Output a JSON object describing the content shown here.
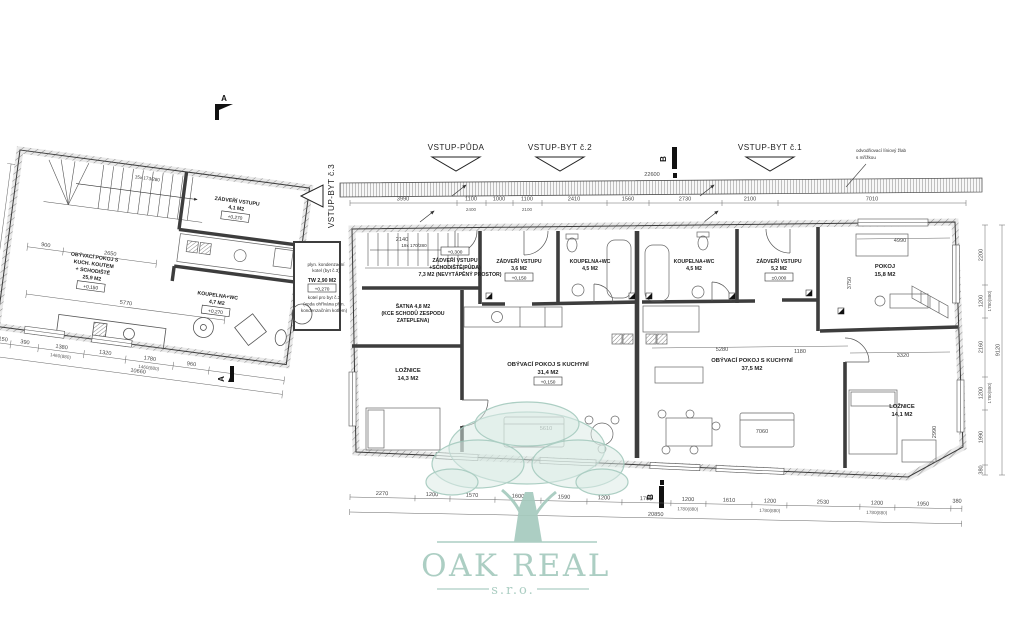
{
  "watermark": {
    "name": "OAK REAL",
    "suffix": "s.r.o.",
    "color": "#a5cabe"
  },
  "entries": {
    "puda": "VSTUP-PŮDA",
    "byt2": "VSTUP-BYT č.2",
    "byt1": "VSTUP-BYT č.1",
    "byt3": "VSTUP-BYT č.3"
  },
  "sections": {
    "a": "A",
    "b": "B"
  },
  "notes": {
    "drain_l1": "odvodňovací líniový žlab",
    "drain_l2": "s mřížkou",
    "boiler_l1": "plyn. kondenzační",
    "boiler_l2": "kotel (byt č.3)",
    "tw": "TW 2,90 M2",
    "boiler_l3": "kotel pro byt č.3",
    "boiler_l4": "(voda ohřívána plyn.",
    "boiler_l5": "kondenzačním kotlem)",
    "stair_left": "15x 173/280",
    "stair_main": "19x 170/280"
  },
  "rooms": {
    "obyv3": {
      "l1": "OBÝVACÍ POKOJ S",
      "l2": "KUCH. KOUTEM",
      "l3": "+ SCHODIŠTĚ",
      "area": "25,9 M2",
      "elev": "+0,150"
    },
    "zadveri3": {
      "l1": "ZÁDVEŘÍ VSTUPU",
      "area": "4,1 M2",
      "elev": "+0,270"
    },
    "koupelna3": {
      "l1": "KOUPELNA+WC",
      "area": "4,7 M2",
      "elev": "+0,270"
    },
    "zadveri_puda": {
      "l1": "ZÁDVEŘÍ VSTUPU",
      "l2": "+SCHODIŠTĚ(PŮDA)",
      "l3": "7,3 M2 (NEVYTÁPĚNÝ PROSTOR)",
      "elev": "+0,300"
    },
    "satna": {
      "l1": "ŠATNA 4,8 M2",
      "l2": "(KCE SCHODŮ ZESPODU",
      "l3": "ZATEPLENA)"
    },
    "zadveri2": {
      "l1": "ZÁDVEŘÍ VSTUPU",
      "area": "3,6 M2",
      "elev": "+0,150"
    },
    "koupelna2": {
      "l1": "KOUPELNA+WC",
      "area": "4,5 M2"
    },
    "koupelna1": {
      "l1": "KOUPELNA+WC",
      "area": "4,5 M2"
    },
    "zadveri1": {
      "l1": "ZÁDVEŘÍ VSTUPU",
      "area": "5,2 M2",
      "elev": "±0,000"
    },
    "pokoj": {
      "l1": "POKOJ",
      "area": "15,8 M2"
    },
    "loznice2": {
      "l1": "LOŽNICE",
      "area": "14,3 M2"
    },
    "obyv2": {
      "l1": "OBÝVACÍ POKOJ S KUCHYNÍ",
      "area": "31,4 M2",
      "elev": "+0,150"
    },
    "obyv1": {
      "l1": "OBÝVACÍ POKOJ S KUCHYNÍ",
      "area": "37,5 M2"
    },
    "loznice1": {
      "l1": "LOŽNICE",
      "area": "14,1 M2"
    }
  },
  "elevations": {
    "minus300": "-0,300"
  },
  "dims": {
    "top": [
      "3990",
      "1100",
      "1000",
      "1100",
      "2410",
      "1560",
      "2730",
      "2100",
      "7010"
    ],
    "top_total": "22600",
    "top_sub1": "2400",
    "top_sub2": "2100",
    "bottom": [
      "2270",
      "1200",
      "1570",
      "1600",
      "1590",
      "1200",
      "1700",
      "1200",
      "1610",
      "1200",
      "2530",
      "1200",
      "1950",
      "380"
    ],
    "bottom_total": "20850",
    "bottom_sub": "1780(880)",
    "right": [
      "2200",
      "1200",
      "2160",
      "1200",
      "1990",
      "380"
    ],
    "right_total": "9120",
    "right_sub": "1780(880)",
    "left": [
      "150",
      "390",
      "1380",
      "1320",
      "1780",
      "960"
    ],
    "left_total": "10660",
    "left_sub": "1460(880)",
    "left_top1": "900",
    "left_top2": "2650",
    "left_mid": "5770",
    "left_v": "4480",
    "inner": {
      "a": "5280",
      "b": "1180",
      "c": "5610",
      "d": "7060",
      "e": "4990",
      "f": "3750",
      "g": "3320",
      "h": "2990",
      "i": "2140"
    }
  }
}
